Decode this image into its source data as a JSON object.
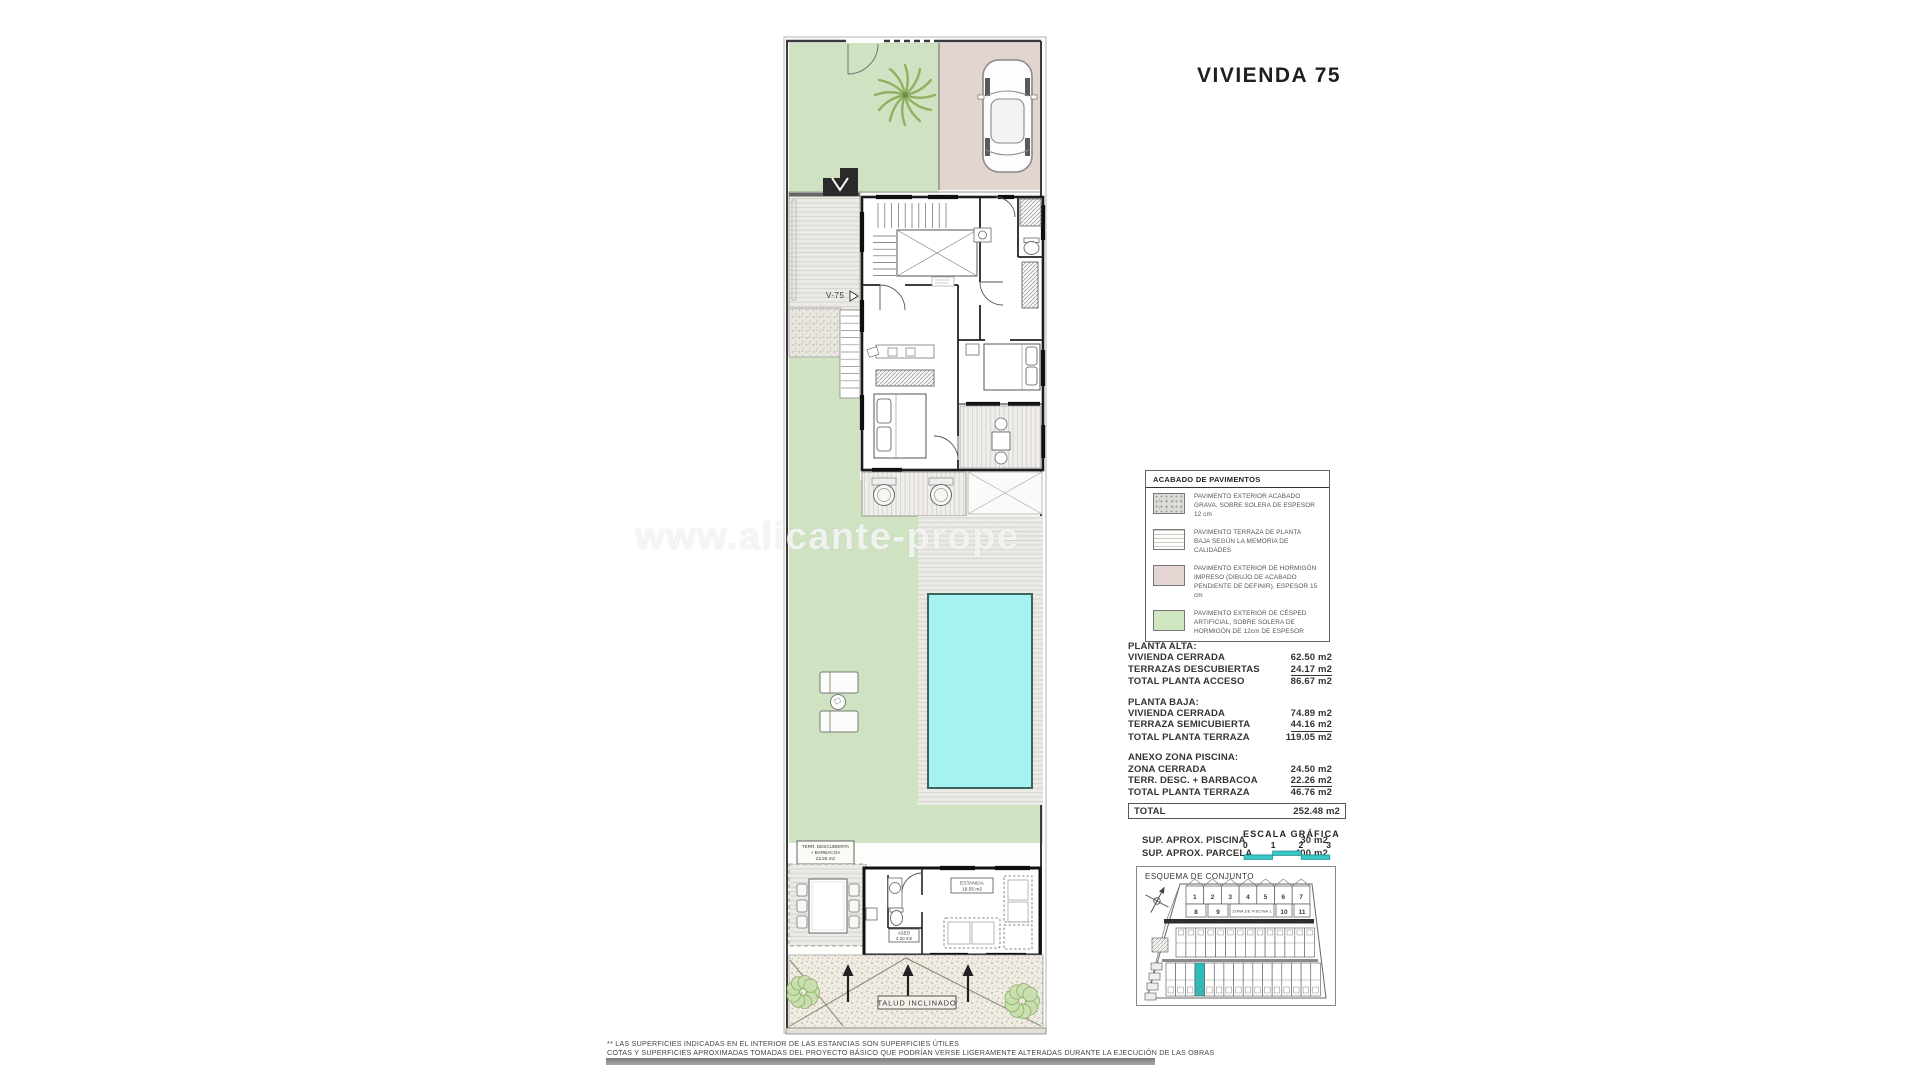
{
  "title": "VIVIENDA 75",
  "watermark": "www.alicante-prope",
  "colors": {
    "accent_teal": "#2bbcbc",
    "pool": "#a6f2f0",
    "garden_green": "#cfe3c2",
    "parking_pink": "#e2d5cf",
    "legend_gravel": "#dddcd8",
    "legend_terrace": "#fdfdfc",
    "legend_concrete": "#e4d5d3",
    "legend_grass": "#cfe7c1"
  },
  "plan": {
    "labels": {
      "v75": "V-75",
      "talud": "TALUD INCLINADO",
      "terr_1": "TERR. DESCUBIERTA",
      "terr_2": "+ BARBACOA",
      "terr_3": "22.26 m2",
      "aseo_1": "ASEO",
      "aseo_2": "4.20 m2",
      "estancia_1": "ESTANCIA",
      "estancia_2": "19.55 m2"
    }
  },
  "legend": {
    "title": "ACABADO DE PAVIMENTOS",
    "rows": [
      {
        "text": "PAVIMENTO EXTERIOR ACABADO GRAVA, SOBRE SOLERA DE ESPESOR 12 cm"
      },
      {
        "text": "PAVIMENTO TERRAZA DE PLANTA BAJA SEGÚN LA MEMORIA DE CALIDADES"
      },
      {
        "text": "PAVIMENTO EXTERIOR DE HORMIGÓN IMPRESO (DIBUJO DE ACABADO PENDIENTE DE DEFINIR), ESPESOR 15 cm"
      },
      {
        "text": "PAVIMENTO EXTERIOR DE CÉSPED ARTIFICIAL, SOBRE SOLERA DE HORMIGÓN DE 12cm DE ESPESOR"
      }
    ]
  },
  "areas": {
    "sections": [
      {
        "title": "PLANTA ALTA:",
        "rows": [
          {
            "label": "VIVIENDA CERRADA",
            "value": "62.50 m2"
          },
          {
            "label": "TERRAZAS DESCUBIERTAS",
            "value": "24.17 m2"
          },
          {
            "label": "TOTAL PLANTA ACCESO",
            "value": "86.67 m2"
          }
        ]
      },
      {
        "title": "PLANTA BAJA:",
        "rows": [
          {
            "label": "VIVIENDA CERRADA",
            "value": "74.89 m2"
          },
          {
            "label": "TERRAZA SEMICUBIERTA",
            "value": "44.16 m2"
          },
          {
            "label": "TOTAL PLANTA TERRAZA",
            "value": "119.05 m2"
          }
        ]
      },
      {
        "title": "ANEXO ZONA PISCINA:",
        "rows": [
          {
            "label": "ZONA CERRADA",
            "value": "24.50 m2"
          },
          {
            "label": "TERR. DESC. + BARBACOA",
            "value": "22.26 m2"
          },
          {
            "label": "TOTAL PLANTA TERRAZA",
            "value": "46.76 m2"
          }
        ]
      }
    ],
    "total": {
      "label": "TOTAL",
      "value": "252.48 m2"
    },
    "extra": [
      {
        "label": "SUP. APROX. PISCINA",
        "value": "30 m2"
      },
      {
        "label": "SUP. APROX. PARCELA",
        "value": "400 m2"
      }
    ]
  },
  "scale": {
    "title": "ESCALA GRÁFICA",
    "ticks": [
      "0",
      "1",
      "2",
      "3"
    ]
  },
  "esquema": {
    "title": "ESQUEMA DE CONJUNTO",
    "zona_piscina": "ZONA DE PISCINA 1",
    "unit_numbers": [
      "1",
      "2",
      "3",
      "4",
      "5",
      "6",
      "7",
      "8",
      "9",
      "10",
      "11"
    ]
  },
  "footer": {
    "line1": "** LAS SUPERFICIES INDICADAS EN EL INTERIOR DE LAS ESTANCIAS SON SUPERFICIES ÚTILES",
    "line2": "COTAS Y SUPERFICIES APROXIMADAS TOMADAS DEL PROYECTO BÁSICO QUE PODRÍAN VERSE LIGERAMENTE ALTERADAS DURANTE LA EJECUCIÓN DE LAS OBRAS"
  }
}
